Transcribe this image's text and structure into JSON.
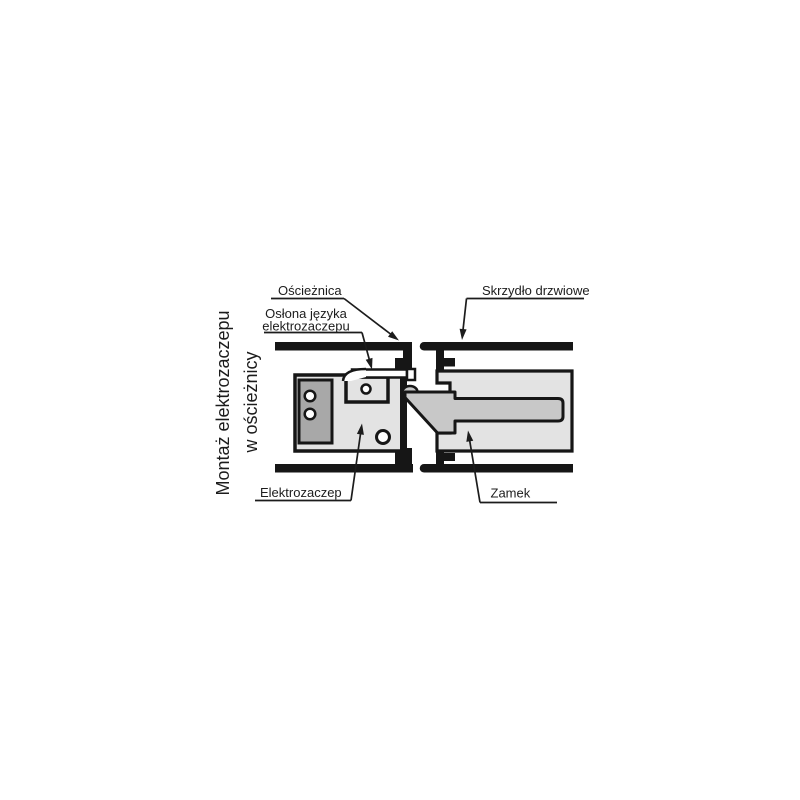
{
  "diagram": {
    "title": {
      "line1": "Montaż elektrozaczepu",
      "line2": "w ościeżnicy"
    },
    "labels": {
      "frame": "Ościeżnica",
      "door_leaf": "Skrzydło drzwiowe",
      "latch_cover_line1": "Osłona języka",
      "latch_cover_line2": "elektrozaczepu",
      "electric_strike": "Elektrozaczep",
      "lock": "Zamek"
    },
    "colors": {
      "outline_black": "#161616",
      "component_light_gray": "#e3e3e3",
      "component_mid_gray": "#a8a8a8",
      "latch_gray": "#c8c8c8",
      "background": "#ffffff"
    }
  }
}
